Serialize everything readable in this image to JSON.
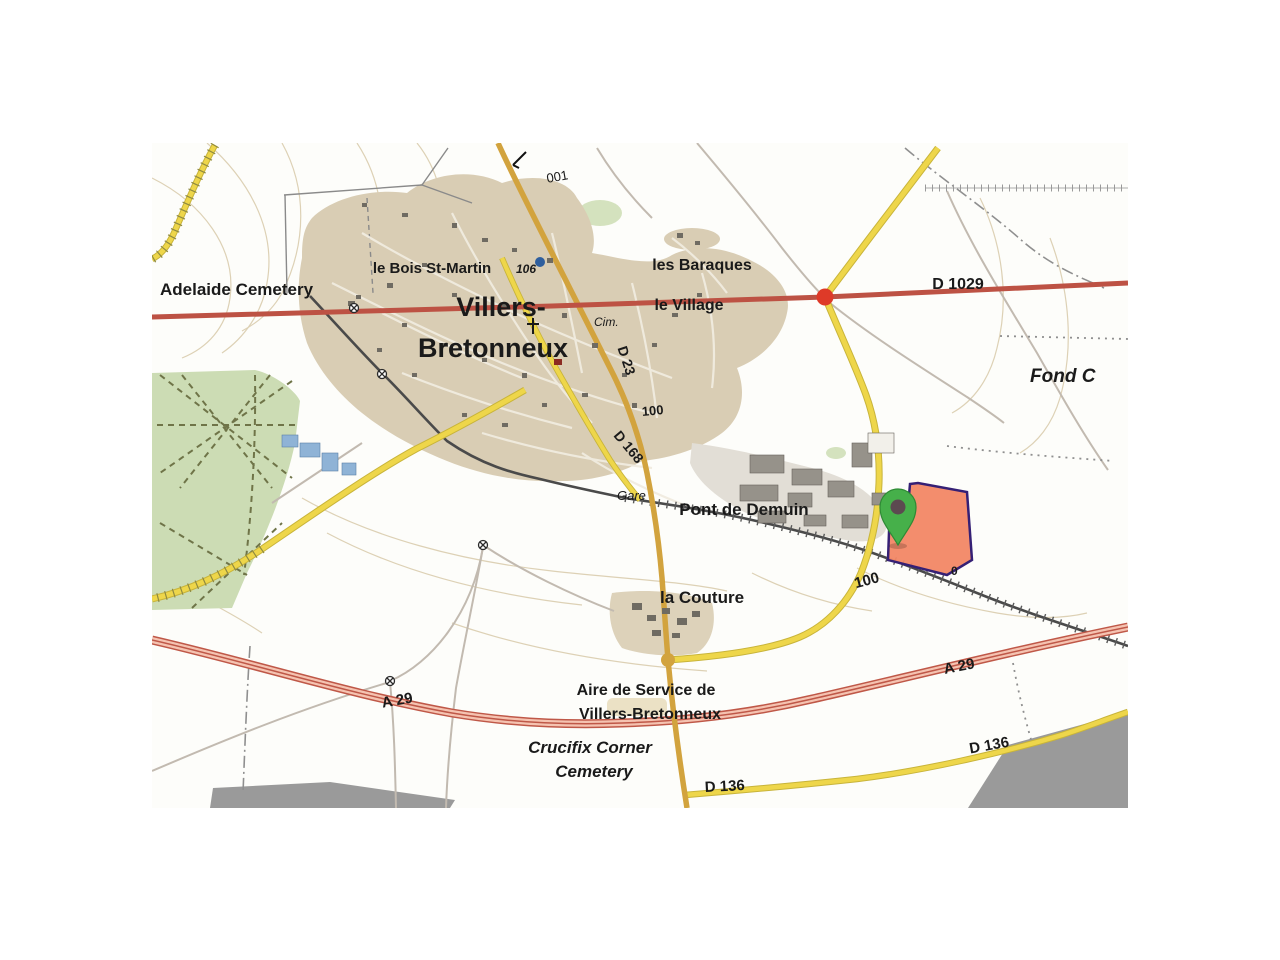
{
  "map": {
    "region_name": "Villers-Bretonneux IGN-style map extract",
    "labels": {
      "adelaide_cemetery": "Adelaide Cemetery",
      "bois_st_martin": "le Bois St-Martin",
      "town_line1": "Villers-",
      "town_line2": "Bretonneux",
      "les_baraques": "les Baraques",
      "le_village": "le Village",
      "cim": "Cim.",
      "fond": "Fond C",
      "gare": "Gare",
      "pont_de_demuin": "Pont de Demuin",
      "la_couture": "la Couture",
      "aire_line1": "Aire de Service de",
      "aire_line2": "Villers-Bretonneux",
      "crucifix_line1": "Crucifix Corner",
      "crucifix_line2": "Cemetery"
    },
    "road_labels": {
      "d1029": "D 1029",
      "d23": "D 23",
      "d168": "D 168",
      "a29_left": "A 29",
      "a29_right": "A 29",
      "d136_bottom": "D 136",
      "d136_right": "D 136"
    },
    "elevation_labels": {
      "contour_001": "001",
      "spot_106": "106",
      "contour_100_red": "100",
      "contour_100_black": "100",
      "contour_0": "0"
    },
    "markers": {
      "location_pin": "green-map-pin",
      "highlighted_parcel": "orange-parcel-with-dark-blue-outline"
    },
    "colors": {
      "main_road_red": "#bd5244",
      "junction_dot_red": "#de3a28",
      "secondary_road_yellow": "#eed64a",
      "tertiary_road_ochre": "#d2a33e",
      "motorway_fill_pink": "#f5c3b1",
      "town_fill_tan": "#d9cdb4",
      "park_green": "#ccdcb4",
      "parcel_fill": "#f28765",
      "parcel_border": "#352075",
      "pin_green": "#46b04a"
    }
  }
}
